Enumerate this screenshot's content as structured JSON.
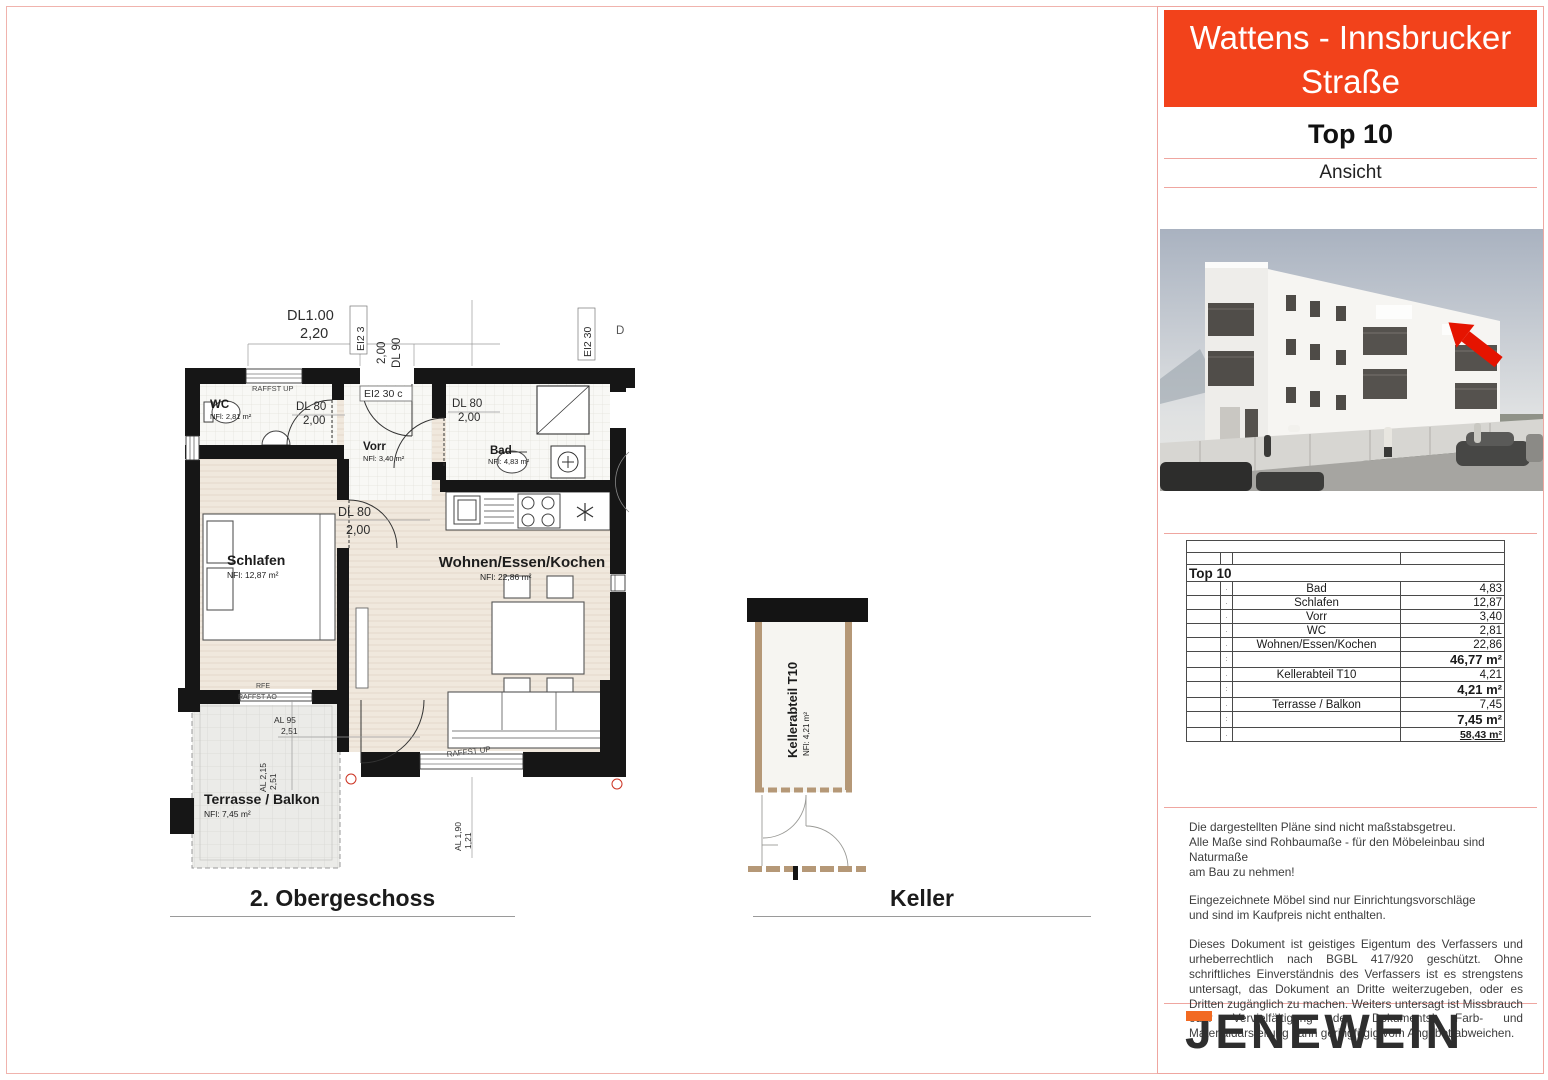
{
  "header": {
    "project_title": "Wattens - Innsbrucker Straße",
    "unit": "Top 10",
    "view_label": "Ansicht"
  },
  "colors": {
    "accent_red": "#f2421b",
    "frame_pink": "#efa6a0",
    "keller_wall_tan": "#b59877",
    "arrow_red": "#e51400",
    "logo_orange": "#f26a22"
  },
  "plans": {
    "floor_caption": "2. Obergeschoss",
    "cellar_caption": "Keller",
    "rooms": {
      "wc": {
        "name": "WC",
        "area": "NFl: 2,81 m²"
      },
      "vorr": {
        "name": "Vorr",
        "area": "NFl: 3,40 m²"
      },
      "bad": {
        "name": "Bad",
        "area": "NFl: 4,83 m²"
      },
      "schlafen": {
        "name": "Schlafen",
        "area": "NFl: 12,87 m²"
      },
      "wohnen": {
        "name": "Wohnen/Essen/Kochen",
        "area": "NFl: 22,86 m²"
      },
      "terrasse": {
        "name": "Terrasse / Balkon",
        "area": "NFl: 7,45 m²"
      },
      "keller": {
        "name": "Kellerabteil T10",
        "area": "NFl: 4,21 m²"
      }
    },
    "annotations": {
      "dl100": "DL1.00",
      "dl100_h": "2,20",
      "ei2_3": "EI2 3",
      "dl90": "DL 90",
      "dl90_h": "2,00",
      "ei2_30": "EI2 30",
      "ei2_30c": "EI2 30 c",
      "d_partial": "D",
      "dl80_wc": "DL 80",
      "dl80_wc_h": "2,00",
      "dl80_bad": "DL 80",
      "dl80_bad_h": "2,00",
      "dl80_schlafen": "DL 80",
      "dl80_schlafen_h": "2,00",
      "raffst_up_top": "RAFFST UP",
      "raffst_up_bottom": "RAFFST UP",
      "rfe": "RFE",
      "raffst_ao": "RAFFST AO",
      "al95": "AL 95",
      "al95_w": "2,51",
      "al215": "AL 2,15",
      "al215_w": "2,51",
      "al190": "AL 1,90",
      "al190_w": "1,21"
    }
  },
  "table": {
    "title": "Top 10",
    "rows": [
      {
        "marker": ".",
        "name": "Bad",
        "value": "4,83"
      },
      {
        "marker": ".",
        "name": "Schlafen",
        "value": "12,87"
      },
      {
        "marker": ".",
        "name": "Vorr",
        "value": "3,40"
      },
      {
        "marker": ".",
        "name": "WC",
        "value": "2,81"
      },
      {
        "marker": ".",
        "name": "Wohnen/Essen/Kochen",
        "value": "22,86"
      },
      {
        "marker": ":",
        "name": "",
        "value": "46,77 m²"
      },
      {
        "marker": ".",
        "name": "Kellerabteil T10",
        "value": "4,21"
      },
      {
        "marker": ":",
        "name": "",
        "value": "4,21 m²"
      },
      {
        "marker": ".",
        "name": "Terrasse / Balkon",
        "value": "7,45"
      },
      {
        "marker": ":",
        "name": "",
        "value": "7,45 m²"
      },
      {
        "marker": ".",
        "name": "",
        "value": "58,43 m²"
      }
    ]
  },
  "notes": {
    "p1": "Die dargestellten Pläne sind nicht maßstabsgetreu.\nAlle Maße sind Rohbaumaße - für den Möbeleinbau sind Naturmaße\nam Bau zu nehmen!",
    "p2": "Eingezeichnete Möbel sind nur Einrichtungsvorschläge\nund sind im Kaufpreis nicht enthalten.",
    "p3": "Dieses Dokument ist geistiges Eigentum des Verfassers und urheberrechtlich nach BGBL 417/920 geschützt. Ohne schriftliches Einverständnis des Verfassers ist es strengstens untersagt, das Dokument an Dritte weiterzugeben, oder es Dritten zugänglich zu machen. Weiters untersagt ist Missbrauch oder Vervielfältigung des Dokuments! Farb- und Materialdarstellung kann geringfügig vom Angebot abweichen."
  },
  "logo": {
    "text": "JENEWEIN"
  }
}
